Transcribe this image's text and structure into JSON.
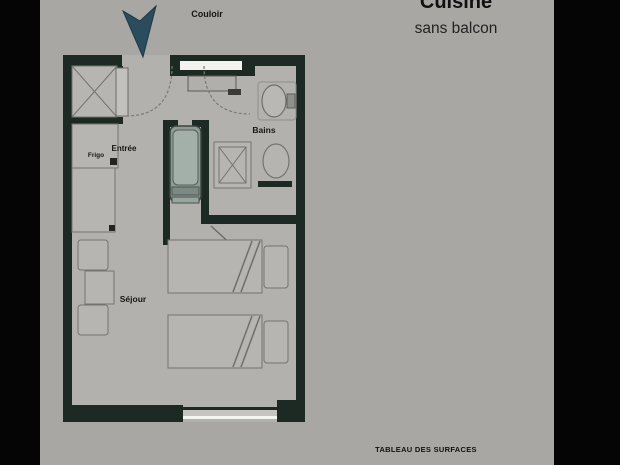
{
  "header": {
    "title": "Cuisine",
    "subtitle": "sans balcon"
  },
  "footer": {
    "caption": "TABLEAU DES SURFACES"
  },
  "plan": {
    "labels": {
      "corridor": "Couloir",
      "entrance": "Entrée",
      "fridge": "Frigo",
      "bathroom": "Bains",
      "living_room": "Séjour"
    }
  },
  "icons": {
    "north_arrow": "north-arrow-icon"
  },
  "colors": {
    "background": "#050505",
    "panel": "#a8a7a3",
    "floor": "#b2b1ad",
    "walls": "#1d2a24",
    "north_arrow": "#2a4c5c",
    "window": "#f2f2ee",
    "bathtub": "#8e9a93",
    "furniture_stroke": "#74746f",
    "text": "#161616"
  }
}
